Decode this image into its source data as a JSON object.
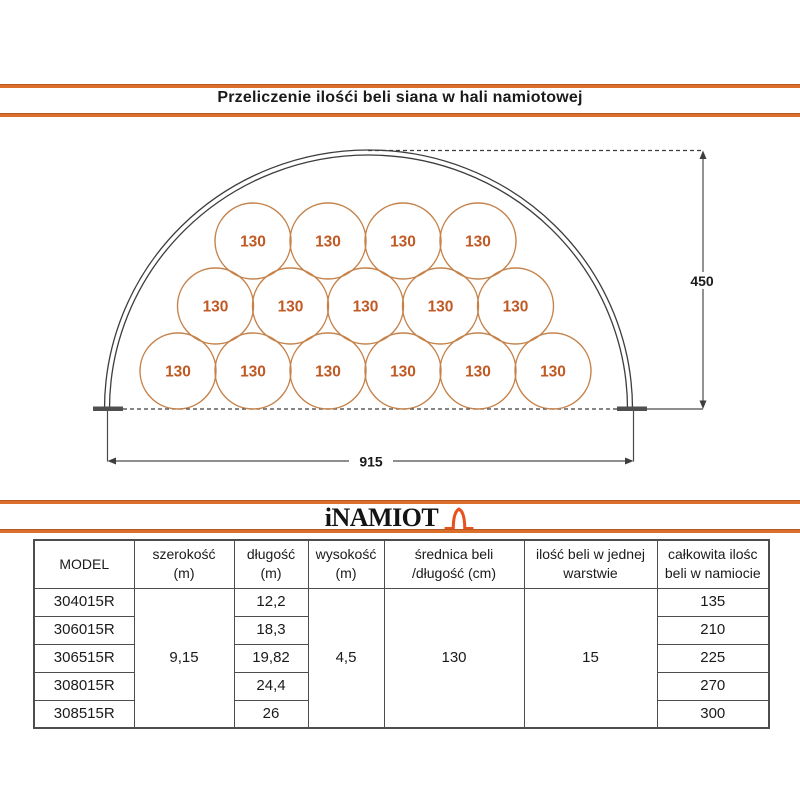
{
  "page": {
    "title": "Przeliczenie ilośći beli siana w hali namiotowej"
  },
  "logo": {
    "text": "iNAMIOT",
    "icon": "tent-arch-icon"
  },
  "diagram": {
    "bale_label": "130",
    "bales_per_row_bottom_to_top": [
      6,
      5,
      4
    ],
    "total_bales_shown": 15,
    "width_dimension": "915",
    "height_dimension": "450"
  },
  "table": {
    "headers": {
      "model": "MODEL",
      "szerokosc_1": "szerokość",
      "szerokosc_2": "(m)",
      "dlugosc_1": "długość",
      "dlugosc_2": "(m)",
      "wysokosc_1": "wysokość",
      "wysokosc_2": "(m)",
      "srednica_1": "średnica beli",
      "srednica_2": "/długość (cm)",
      "ilosc_1": "ilość beli w jednej",
      "ilosc_2": "warstwie",
      "calkowita_1": "całkowita ilośc",
      "calkowita_2": "beli w namiocie"
    },
    "merged": {
      "szerokosc": "9,15",
      "wysokosc": "4,5",
      "srednica": "130",
      "ilosc_warstwa": "15"
    },
    "rows": [
      {
        "model": "304015R",
        "dlugosc": "12,2",
        "calkowita": "135"
      },
      {
        "model": "306015R",
        "dlugosc": "18,3",
        "calkowita": "210"
      },
      {
        "model": "306515R",
        "dlugosc": "19,82",
        "calkowita": "225"
      },
      {
        "model": "308015R",
        "dlugosc": "24,4",
        "calkowita": "270"
      },
      {
        "model": "308515R",
        "dlugosc": "26",
        "calkowita": "300"
      }
    ]
  },
  "colors": {
    "accent_orange": "#dd6f2d",
    "logo_orange": "#e8521d",
    "bale_stroke": "#c5824a",
    "bale_text": "#c05a24",
    "drawing_line": "#3d3d3d"
  }
}
